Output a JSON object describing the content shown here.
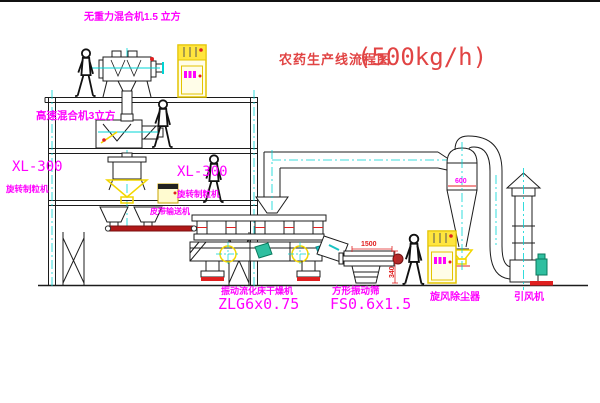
{
  "title": {
    "text": "农药生产线流程图",
    "capacity": "(500kg/h)"
  },
  "equipment_labels": {
    "gravity_mixer": "无重力混合机1.5 立方",
    "high_speed_mixer": "高速混合机3立方",
    "granulator_left": {
      "model": "XL-300",
      "name": "旋转制粒机"
    },
    "granulator_right": {
      "model": "XL-300",
      "name": "旋转制粒机"
    },
    "belt_conveyor": "皮带输送机",
    "fluid_bed_dryer": {
      "name": "振动流化床干燥机",
      "model": "ZLG6x0.75"
    },
    "vibrating_sieve": {
      "name": "方形振动筛",
      "model": "FS0.6x1.5"
    },
    "cyclone_dust_collector": "旋风除尘器",
    "induced_draft_fan": "引风机"
  },
  "dimensions": {
    "sieve_width": "1500",
    "sieve_height": "340",
    "cyclone_diameter": "600"
  },
  "colors": {
    "label_magenta": "#ff00ff",
    "title_red": "#e14444",
    "dimension_red": "#e02020",
    "line_black": "#1c1c1c",
    "cad_yellow": "#f2d600",
    "cad_cyan": "#00d4d4",
    "motor_green": "#2fbfa0"
  }
}
